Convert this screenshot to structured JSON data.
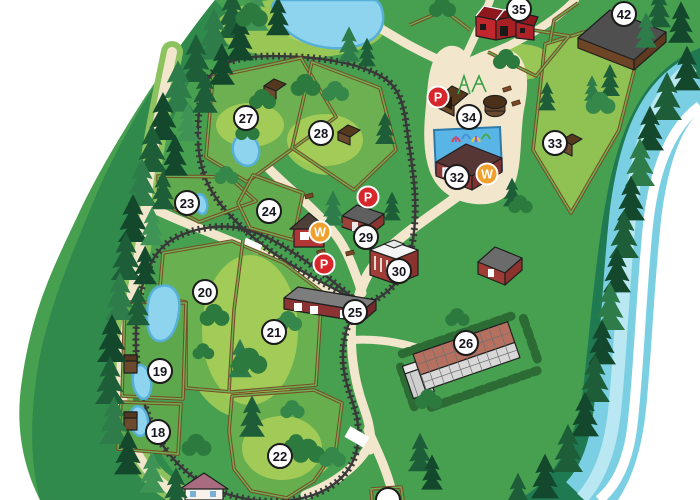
{
  "map": {
    "colors": {
      "parking_red": "#d7262c",
      "water_amber": "#f0a02c",
      "marker_ring": "#1b1b1b",
      "marker_fill": "#ffffff",
      "path_cream": "#f2e7cd",
      "river_blue": "#7bcfe3",
      "land_green": "#46a050"
    },
    "markers": [
      {
        "id": "map-marker-18",
        "label": "18",
        "x": 158,
        "y": 432,
        "type": "number"
      },
      {
        "id": "map-marker-19",
        "label": "19",
        "x": 160,
        "y": 371,
        "type": "number"
      },
      {
        "id": "map-marker-20",
        "label": "20",
        "x": 205,
        "y": 292,
        "type": "number"
      },
      {
        "id": "map-marker-21",
        "label": "21",
        "x": 274,
        "y": 332,
        "type": "number"
      },
      {
        "id": "map-marker-22",
        "label": "22",
        "x": 280,
        "y": 456,
        "type": "number"
      },
      {
        "id": "map-marker-23",
        "label": "23",
        "x": 187,
        "y": 203,
        "type": "number"
      },
      {
        "id": "map-marker-24",
        "label": "24",
        "x": 269,
        "y": 211,
        "type": "number"
      },
      {
        "id": "map-marker-25",
        "label": "25",
        "x": 355,
        "y": 312,
        "type": "number"
      },
      {
        "id": "map-marker-26",
        "label": "26",
        "x": 466,
        "y": 343,
        "type": "number"
      },
      {
        "id": "map-marker-27",
        "label": "27",
        "x": 246,
        "y": 118,
        "type": "number"
      },
      {
        "id": "map-marker-28",
        "label": "28",
        "x": 321,
        "y": 133,
        "type": "number"
      },
      {
        "id": "map-marker-29",
        "label": "29",
        "x": 366,
        "y": 237,
        "type": "number"
      },
      {
        "id": "map-marker-30",
        "label": "30",
        "x": 399,
        "y": 271,
        "type": "number"
      },
      {
        "id": "map-marker-32",
        "label": "32",
        "x": 457,
        "y": 177,
        "type": "number"
      },
      {
        "id": "map-marker-33",
        "label": "33",
        "x": 555,
        "y": 143,
        "type": "number"
      },
      {
        "id": "map-marker-34",
        "label": "34",
        "x": 469,
        "y": 117,
        "type": "number"
      },
      {
        "id": "map-marker-35",
        "label": "35",
        "x": 519,
        "y": 9,
        "type": "number"
      },
      {
        "id": "map-marker-42",
        "label": "42",
        "x": 624,
        "y": 14,
        "type": "number"
      },
      {
        "id": "map-marker-edge",
        "label": "",
        "x": 388,
        "y": 500,
        "type": "number"
      },
      {
        "id": "parking-marker-1",
        "label": "P",
        "x": 438,
        "y": 97,
        "type": "parking"
      },
      {
        "id": "parking-marker-2",
        "label": "P",
        "x": 368,
        "y": 197,
        "type": "parking"
      },
      {
        "id": "parking-marker-3",
        "label": "P",
        "x": 324,
        "y": 264,
        "type": "parking"
      },
      {
        "id": "water-marker-1",
        "label": "W",
        "x": 487,
        "y": 174,
        "type": "water"
      },
      {
        "id": "water-marker-2",
        "label": "W",
        "x": 320,
        "y": 232,
        "type": "water"
      }
    ]
  }
}
